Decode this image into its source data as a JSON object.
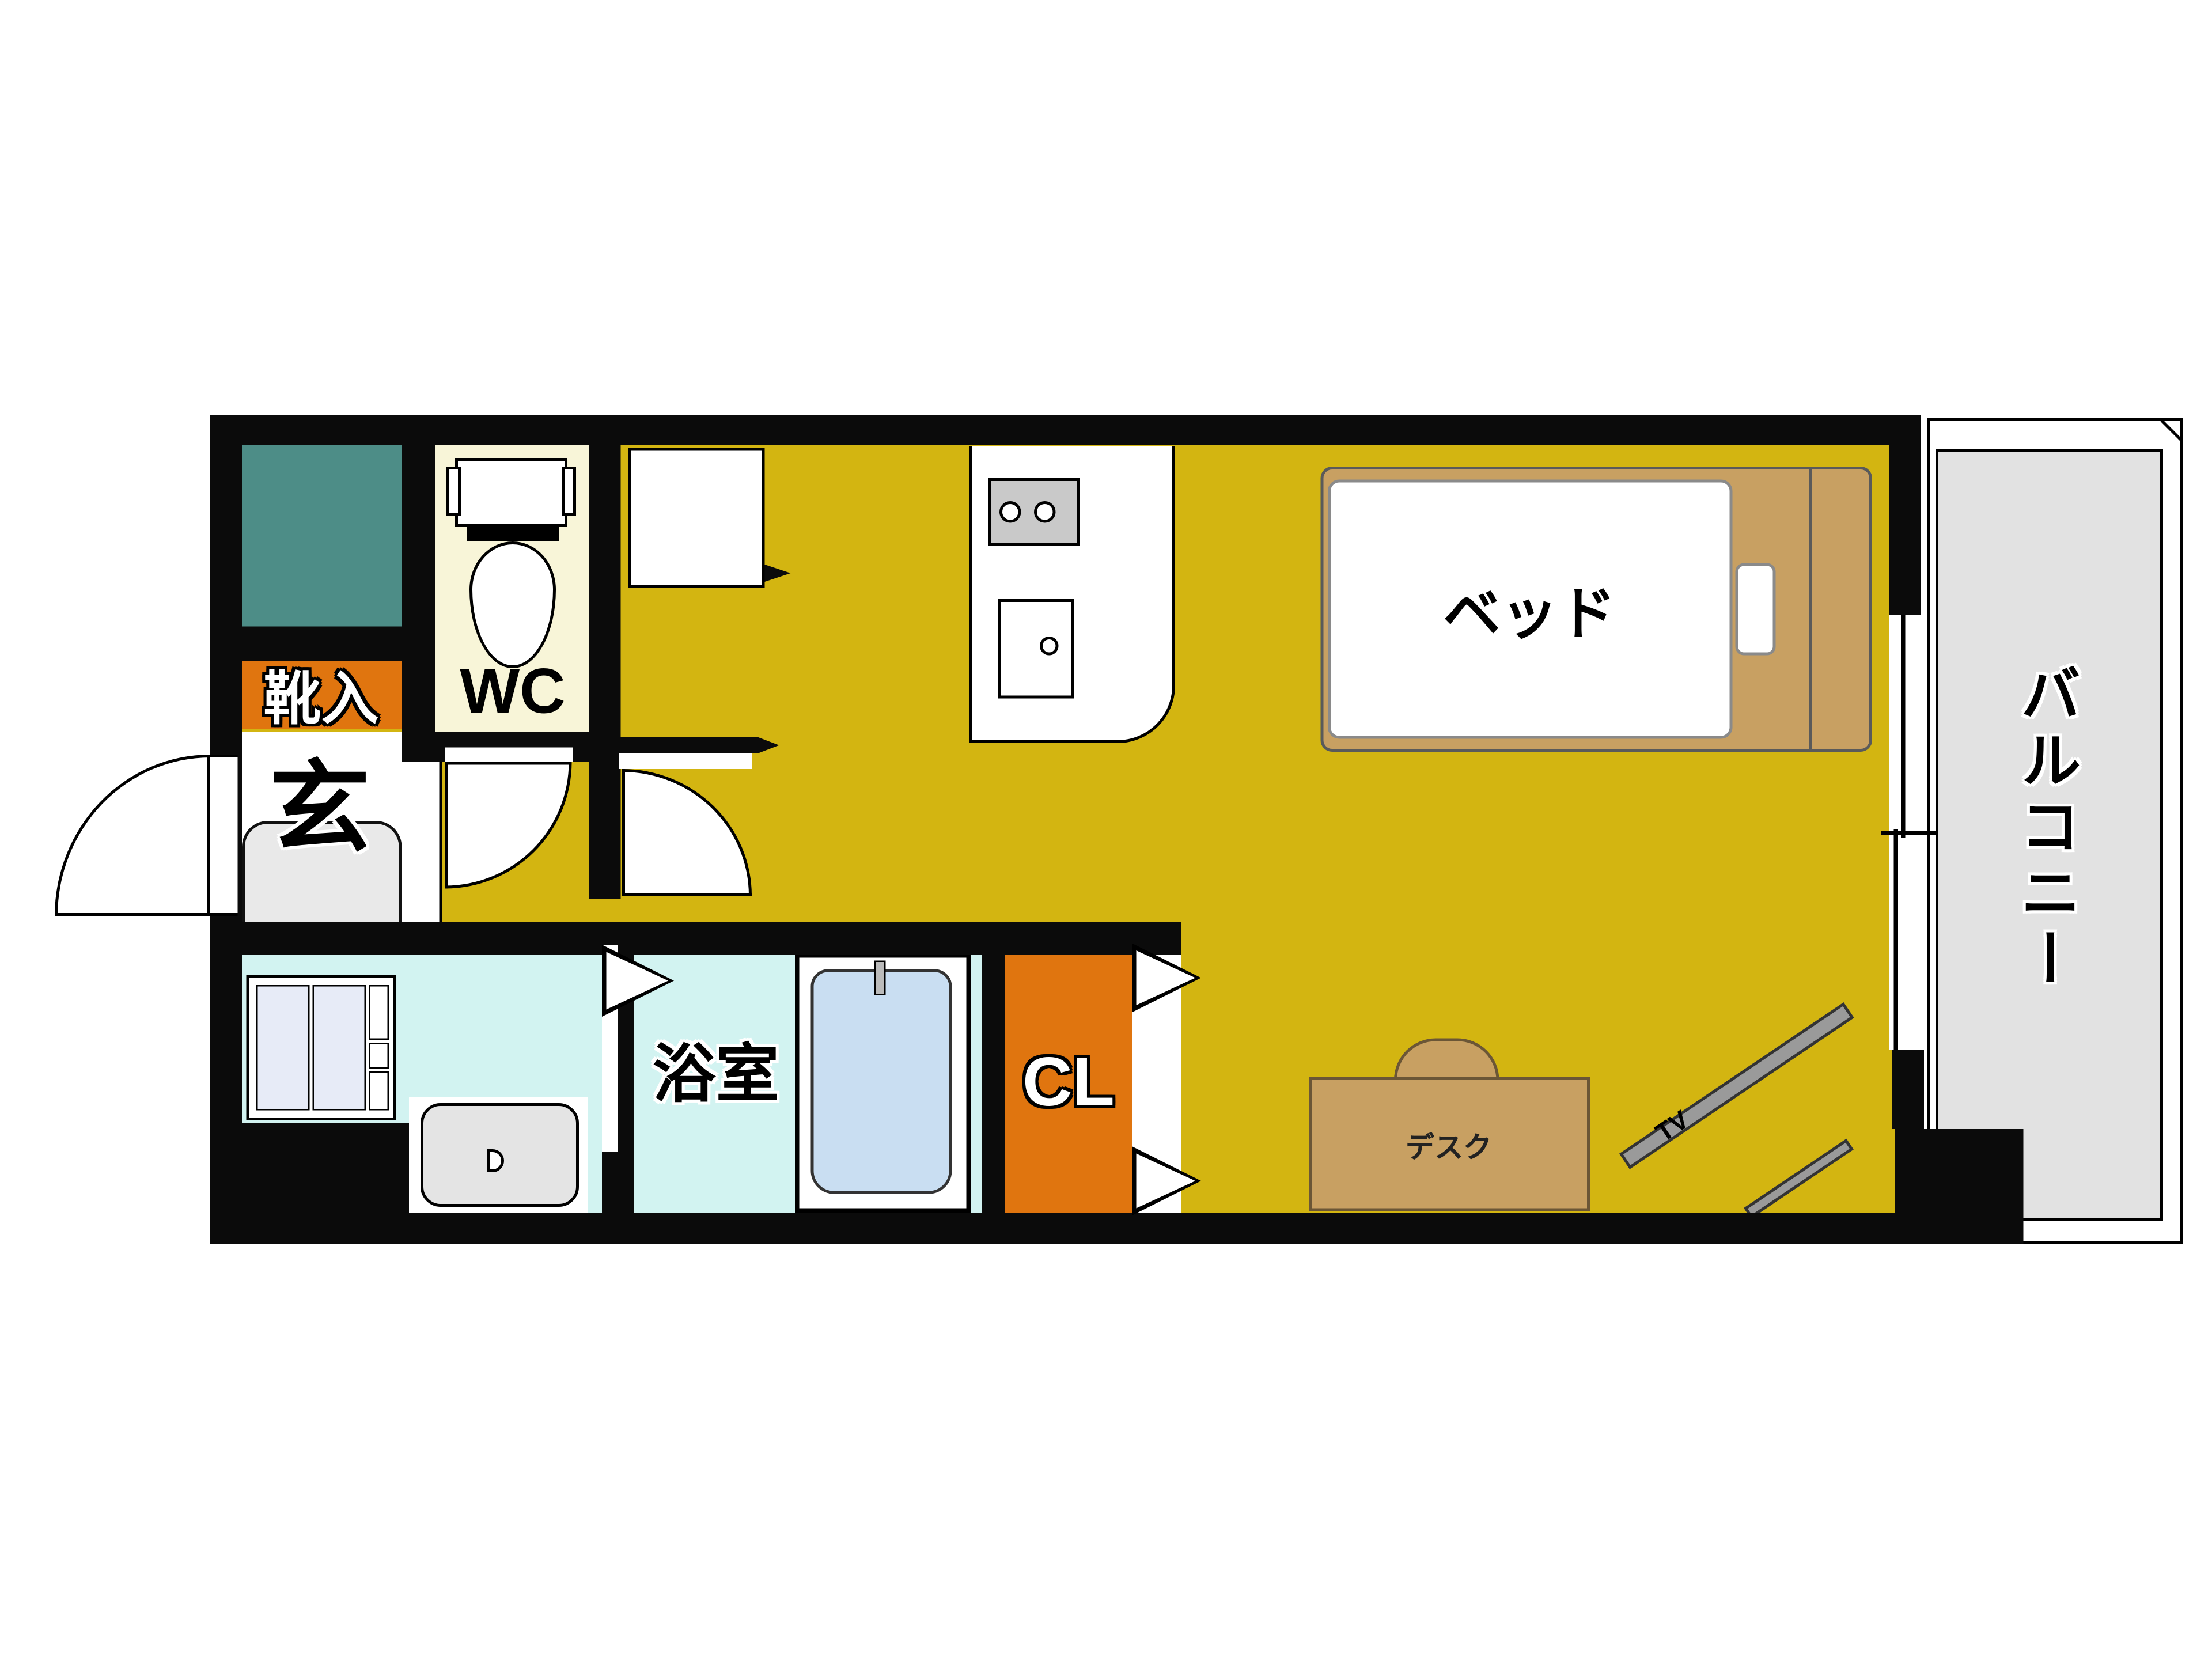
{
  "title": "Japanese studio apartment floor plan",
  "labels": {
    "balcony": "バルコニー",
    "bed": "ベッド",
    "desk": "デスク",
    "tv": "TV",
    "closet": "CL",
    "bathroom": "浴室",
    "entrance": "玄",
    "shoe_cabinet": "靴入",
    "toilet": "WC"
  },
  "colors": {
    "wall": "#0b0b0b",
    "floor": "#d3b511",
    "teal": "#4d8d87",
    "orange": "#e0750f",
    "cream": "#f8f5d8",
    "cyan": "#d2f3f1",
    "tub": "#c9def2",
    "tan": "#c8a062",
    "tanline": "#6b5636",
    "balcony": "#e2e2e2",
    "genkan": "#e9e9e9",
    "sink": "#e4e4e4",
    "stove": "#c9c9c9",
    "panel": "#e7ebf7",
    "tv": "#9a9a9a"
  }
}
